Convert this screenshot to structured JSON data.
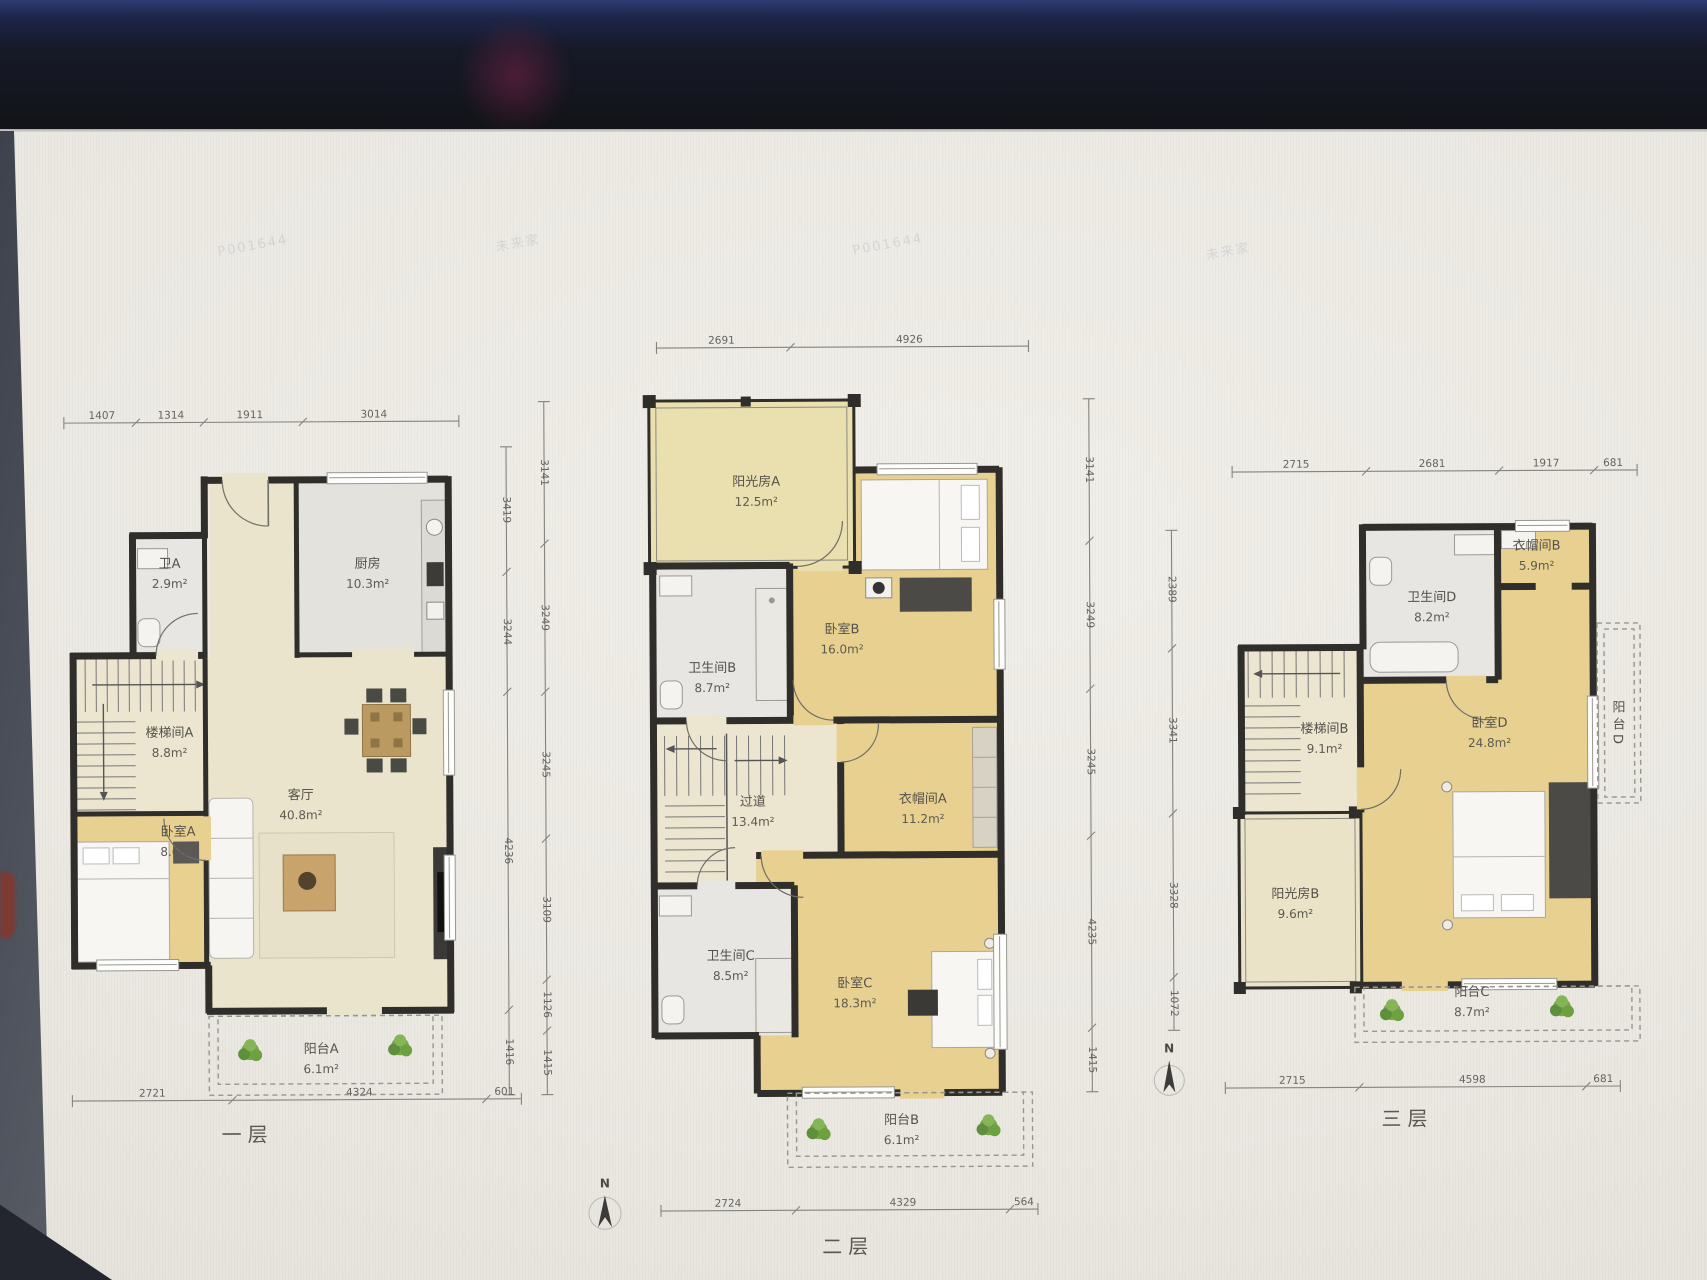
{
  "scene": {
    "north_label": "N",
    "watermark_a": "P001644",
    "watermark_b": "未来家"
  },
  "floor1": {
    "label": "一层",
    "rooms": {
      "bath_a": {
        "name": "卫A",
        "area": "2.9m²"
      },
      "kitchen": {
        "name": "厨房",
        "area": "10.3m²"
      },
      "stair_a": {
        "name": "楼梯间A",
        "area": "8.8m²"
      },
      "living": {
        "name": "客厅",
        "area": "40.8m²"
      },
      "bedroom_a": {
        "name": "卧室A",
        "area": "8.6m²"
      },
      "balcony_a": {
        "name": "阳台A",
        "area": "6.1m²"
      }
    },
    "dims": {
      "top": [
        "1407",
        "1314",
        "1911",
        "3014"
      ],
      "right": [
        "3419",
        "3244",
        "4236",
        "1416"
      ],
      "bottom": [
        "2721",
        "4324",
        "601"
      ]
    }
  },
  "floor2": {
    "label": "二层",
    "rooms": {
      "sunroom_a": {
        "name": "阳光房A",
        "area": "12.5m²"
      },
      "bath_b": {
        "name": "卫生间B",
        "area": "8.7m²"
      },
      "bedroom_b": {
        "name": "卧室B",
        "area": "16.0m²"
      },
      "hallway": {
        "name": "过道",
        "area": "13.4m²"
      },
      "closet_a": {
        "name": "衣帽间A",
        "area": "11.2m²"
      },
      "bath_c": {
        "name": "卫生间C",
        "area": "8.5m²"
      },
      "bedroom_c": {
        "name": "卧室C",
        "area": "18.3m²"
      },
      "balcony_b": {
        "name": "阳台B",
        "area": "6.1m²"
      }
    },
    "dims": {
      "top": [
        "2691",
        "4926"
      ],
      "left": [
        "3141",
        "3249",
        "3245",
        "3109",
        "1126",
        "1415"
      ],
      "right": [
        "3141",
        "3249",
        "3245",
        "4235",
        "1415"
      ],
      "bottom": [
        "2724",
        "4329",
        "564"
      ]
    }
  },
  "floor3": {
    "label": "三层",
    "rooms": {
      "closet_b": {
        "name": "衣帽间B",
        "area": "5.9m²"
      },
      "bath_d": {
        "name": "卫生间D",
        "area": "8.2m²"
      },
      "stair_b": {
        "name": "楼梯间B",
        "area": "9.1m²"
      },
      "bedroom_d": {
        "name": "卧室D",
        "area": "24.8m²"
      },
      "sunroom_b": {
        "name": "阳光房B",
        "area": "9.6m²"
      },
      "balcony_c": {
        "name": "阳台C",
        "area": "8.7m²"
      },
      "balcony_d": {
        "name": "阳台D",
        "area": ""
      }
    },
    "dims": {
      "top": [
        "2715",
        "2681",
        "1917",
        "681"
      ],
      "left": [
        "2389",
        "3341",
        "3328",
        "1072"
      ],
      "bottom": [
        "2715",
        "4598",
        "681"
      ]
    }
  }
}
